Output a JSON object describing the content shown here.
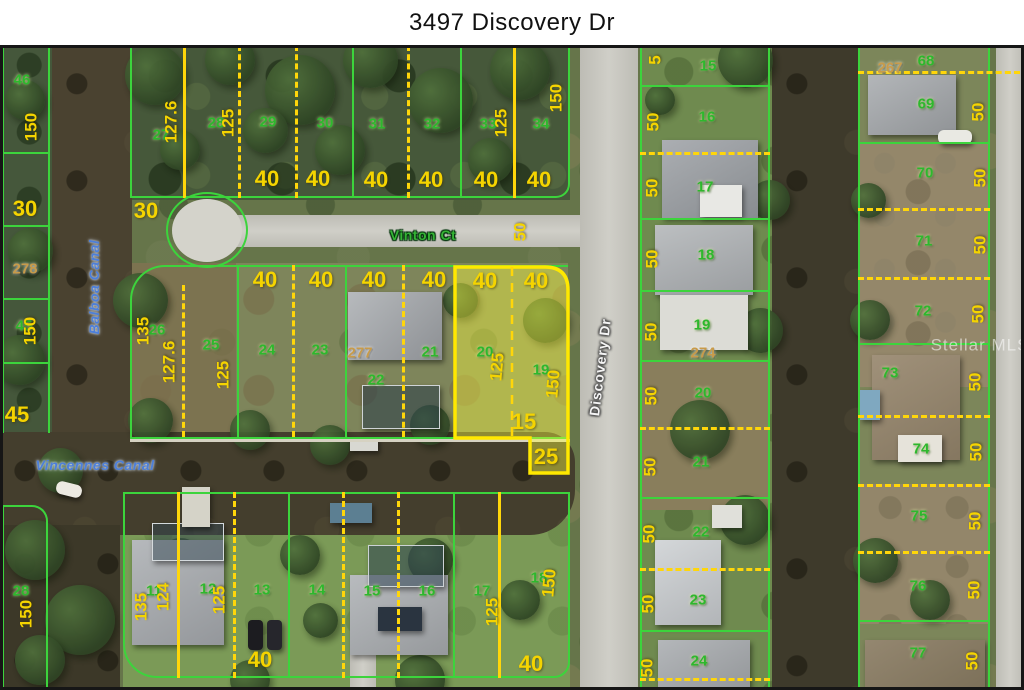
{
  "title": "3497 Discovery Dr",
  "watermark": "Stellar MLS",
  "streets": {
    "vinton": "Vinton Ct",
    "discovery": "Discovery Dr"
  },
  "canals": {
    "balboa": "Balboa Canal",
    "vincennes": "Vincennes Canal"
  },
  "highlighted_parcel": {
    "lot_numbers": [
      "20",
      "19"
    ],
    "dimensions": [
      "40",
      "40",
      "125",
      "150",
      "15",
      "25"
    ]
  },
  "colors": {
    "parcel_line_green": "#3cd43c",
    "dimension_yellow": "#ffd60a",
    "highlight_fill": "#ffff3c",
    "highlight_border": "#ffe800",
    "lot_number_green": "#2db82d",
    "parcel_id_tan": "#c89b4a",
    "canal_label_blue": "#4d7fd9",
    "road_label_white": "#f4f4f4"
  },
  "map_labels": [
    {
      "text": "46",
      "x": 22,
      "y": 80,
      "rot": 0,
      "type": "lot"
    },
    {
      "text": "150",
      "x": 31,
      "y": 127,
      "rot": -90,
      "type": "dim"
    },
    {
      "text": "30",
      "x": 25,
      "y": 209,
      "rot": 0,
      "type": "dimlg"
    },
    {
      "text": "278",
      "x": 25,
      "y": 269,
      "rot": 0,
      "type": "tan"
    },
    {
      "text": "45",
      "x": 24,
      "y": 326,
      "rot": 0,
      "type": "lot"
    },
    {
      "text": "150",
      "x": 30,
      "y": 331,
      "rot": -90,
      "type": "dim"
    },
    {
      "text": "45",
      "x": 17,
      "y": 415,
      "rot": 0,
      "type": "dimlg"
    },
    {
      "text": "28",
      "x": 21,
      "y": 591,
      "rot": 0,
      "type": "lot"
    },
    {
      "text": "150",
      "x": 26,
      "y": 614,
      "rot": -90,
      "type": "dim"
    },
    {
      "text": "Balboa Canal",
      "x": 94,
      "y": 287,
      "rot": -90,
      "type": "water-lbl"
    },
    {
      "text": "Vincennes Canal",
      "x": 95,
      "y": 465,
      "rot": 0,
      "type": "water-lbl"
    },
    {
      "text": "27",
      "x": 161,
      "y": 135,
      "rot": 0,
      "type": "lot"
    },
    {
      "text": "127.6",
      "x": 171,
      "y": 122,
      "rot": -90,
      "type": "dim"
    },
    {
      "text": "28",
      "x": 216,
      "y": 123,
      "rot": 0,
      "type": "lot"
    },
    {
      "text": "125",
      "x": 228,
      "y": 123,
      "rot": -90,
      "type": "dim"
    },
    {
      "text": "29",
      "x": 268,
      "y": 122,
      "rot": 0,
      "type": "lot"
    },
    {
      "text": "30",
      "x": 325,
      "y": 123,
      "rot": 0,
      "type": "lot"
    },
    {
      "text": "31",
      "x": 377,
      "y": 124,
      "rot": 0,
      "type": "lot"
    },
    {
      "text": "32",
      "x": 432,
      "y": 124,
      "rot": 0,
      "type": "lot"
    },
    {
      "text": "33",
      "x": 488,
      "y": 124,
      "rot": 0,
      "type": "lot"
    },
    {
      "text": "125",
      "x": 501,
      "y": 123,
      "rot": -90,
      "type": "dim"
    },
    {
      "text": "34",
      "x": 541,
      "y": 124,
      "rot": 0,
      "type": "lot"
    },
    {
      "text": "150",
      "x": 556,
      "y": 98,
      "rot": -90,
      "type": "dim"
    },
    {
      "text": "40",
      "x": 267,
      "y": 179,
      "rot": 0,
      "type": "dimlg"
    },
    {
      "text": "40",
      "x": 318,
      "y": 179,
      "rot": 0,
      "type": "dimlg"
    },
    {
      "text": "40",
      "x": 376,
      "y": 180,
      "rot": 0,
      "type": "dimlg"
    },
    {
      "text": "40",
      "x": 431,
      "y": 180,
      "rot": 0,
      "type": "dimlg"
    },
    {
      "text": "40",
      "x": 486,
      "y": 180,
      "rot": 0,
      "type": "dimlg"
    },
    {
      "text": "40",
      "x": 539,
      "y": 180,
      "rot": 0,
      "type": "dimlg"
    },
    {
      "text": "30",
      "x": 146,
      "y": 211,
      "rot": 0,
      "type": "dimlg"
    },
    {
      "text": "Vinton Ct",
      "x": 423,
      "y": 235,
      "rot": 0,
      "type": "street"
    },
    {
      "text": "50",
      "x": 520,
      "y": 232,
      "rot": -90,
      "type": "dim"
    },
    {
      "text": "26",
      "x": 157,
      "y": 330,
      "rot": 0,
      "type": "lot"
    },
    {
      "text": "135",
      "x": 143,
      "y": 331,
      "rot": -90,
      "type": "dim"
    },
    {
      "text": "127.6",
      "x": 169,
      "y": 362,
      "rot": -90,
      "type": "dim"
    },
    {
      "text": "25",
      "x": 211,
      "y": 345,
      "rot": 0,
      "type": "lot"
    },
    {
      "text": "125",
      "x": 223,
      "y": 375,
      "rot": -90,
      "type": "dim"
    },
    {
      "text": "24",
      "x": 267,
      "y": 350,
      "rot": 0,
      "type": "lot"
    },
    {
      "text": "23",
      "x": 320,
      "y": 350,
      "rot": 0,
      "type": "lot"
    },
    {
      "text": "277",
      "x": 360,
      "y": 353,
      "rot": 0,
      "type": "tan"
    },
    {
      "text": "22",
      "x": 376,
      "y": 380,
      "rot": 0,
      "type": "lot"
    },
    {
      "text": "21",
      "x": 430,
      "y": 352,
      "rot": 0,
      "type": "lot"
    },
    {
      "text": "40",
      "x": 265,
      "y": 280,
      "rot": 0,
      "type": "dimlg"
    },
    {
      "text": "40",
      "x": 321,
      "y": 280,
      "rot": 0,
      "type": "dimlg"
    },
    {
      "text": "40",
      "x": 374,
      "y": 280,
      "rot": 0,
      "type": "dimlg"
    },
    {
      "text": "40",
      "x": 434,
      "y": 280,
      "rot": 0,
      "type": "dimlg"
    },
    {
      "text": "40",
      "x": 485,
      "y": 281,
      "rot": 0,
      "type": "dimlg"
    },
    {
      "text": "40",
      "x": 536,
      "y": 281,
      "rot": 0,
      "type": "dimlg"
    },
    {
      "text": "20",
      "x": 485,
      "y": 352,
      "rot": 0,
      "type": "lot"
    },
    {
      "text": "125",
      "x": 497,
      "y": 367,
      "rot": -85,
      "type": "dim"
    },
    {
      "text": "19",
      "x": 541,
      "y": 370,
      "rot": 0,
      "type": "lot"
    },
    {
      "text": "150",
      "x": 553,
      "y": 384,
      "rot": -85,
      "type": "dim"
    },
    {
      "text": "15",
      "x": 524,
      "y": 422,
      "rot": 0,
      "type": "dimlg"
    },
    {
      "text": "25",
      "x": 546,
      "y": 457,
      "rot": 0,
      "type": "dimlg"
    },
    {
      "text": "Discovery Dr",
      "x": 600,
      "y": 367,
      "rot": -83,
      "type": "roadname"
    },
    {
      "text": "5",
      "x": 655,
      "y": 60,
      "rot": -90,
      "type": "dim"
    },
    {
      "text": "15",
      "x": 708,
      "y": 66,
      "rot": 0,
      "type": "lot"
    },
    {
      "text": "50",
      "x": 653,
      "y": 122,
      "rot": -90,
      "type": "dim"
    },
    {
      "text": "16",
      "x": 707,
      "y": 117,
      "rot": 0,
      "type": "lot"
    },
    {
      "text": "50",
      "x": 652,
      "y": 188,
      "rot": -90,
      "type": "dim"
    },
    {
      "text": "17",
      "x": 705,
      "y": 187,
      "rot": 0,
      "type": "lot"
    },
    {
      "text": "50",
      "x": 652,
      "y": 259,
      "rot": -90,
      "type": "dim"
    },
    {
      "text": "18",
      "x": 706,
      "y": 255,
      "rot": 0,
      "type": "lot"
    },
    {
      "text": "50",
      "x": 651,
      "y": 332,
      "rot": -90,
      "type": "dim"
    },
    {
      "text": "19",
      "x": 702,
      "y": 325,
      "rot": 0,
      "type": "lot"
    },
    {
      "text": "274",
      "x": 703,
      "y": 353,
      "rot": 0,
      "type": "tan"
    },
    {
      "text": "50",
      "x": 651,
      "y": 396,
      "rot": -90,
      "type": "dim"
    },
    {
      "text": "20",
      "x": 703,
      "y": 393,
      "rot": 0,
      "type": "lot"
    },
    {
      "text": "50",
      "x": 650,
      "y": 467,
      "rot": -90,
      "type": "dim"
    },
    {
      "text": "21",
      "x": 701,
      "y": 462,
      "rot": 0,
      "type": "lot"
    },
    {
      "text": "50",
      "x": 649,
      "y": 534,
      "rot": -90,
      "type": "dim"
    },
    {
      "text": "22",
      "x": 701,
      "y": 532,
      "rot": 0,
      "type": "lot"
    },
    {
      "text": "50",
      "x": 648,
      "y": 604,
      "rot": -90,
      "type": "dim"
    },
    {
      "text": "23",
      "x": 698,
      "y": 600,
      "rot": 0,
      "type": "lot"
    },
    {
      "text": "50",
      "x": 647,
      "y": 668,
      "rot": -90,
      "type": "dim"
    },
    {
      "text": "24",
      "x": 699,
      "y": 661,
      "rot": 0,
      "type": "lot"
    },
    {
      "text": "267",
      "x": 890,
      "y": 68,
      "rot": 0,
      "type": "tan"
    },
    {
      "text": "68",
      "x": 926,
      "y": 61,
      "rot": 0,
      "type": "lot"
    },
    {
      "text": "69",
      "x": 926,
      "y": 104,
      "rot": 0,
      "type": "lot"
    },
    {
      "text": "50",
      "x": 978,
      "y": 112,
      "rot": -90,
      "type": "dim"
    },
    {
      "text": "70",
      "x": 925,
      "y": 173,
      "rot": 0,
      "type": "lot"
    },
    {
      "text": "50",
      "x": 980,
      "y": 178,
      "rot": -90,
      "type": "dim"
    },
    {
      "text": "71",
      "x": 924,
      "y": 241,
      "rot": 0,
      "type": "lot"
    },
    {
      "text": "50",
      "x": 980,
      "y": 245,
      "rot": -90,
      "type": "dim"
    },
    {
      "text": "72",
      "x": 923,
      "y": 311,
      "rot": 0,
      "type": "lot"
    },
    {
      "text": "50",
      "x": 978,
      "y": 314,
      "rot": -90,
      "type": "dim"
    },
    {
      "text": "73",
      "x": 890,
      "y": 373,
      "rot": 0,
      "type": "lot"
    },
    {
      "text": "50",
      "x": 975,
      "y": 382,
      "rot": -90,
      "type": "dim"
    },
    {
      "text": "74",
      "x": 921,
      "y": 449,
      "rot": 0,
      "type": "lot"
    },
    {
      "text": "50",
      "x": 976,
      "y": 452,
      "rot": -90,
      "type": "dim"
    },
    {
      "text": "75",
      "x": 919,
      "y": 516,
      "rot": 0,
      "type": "lot"
    },
    {
      "text": "50",
      "x": 975,
      "y": 521,
      "rot": -90,
      "type": "dim"
    },
    {
      "text": "76",
      "x": 918,
      "y": 586,
      "rot": 0,
      "type": "lot"
    },
    {
      "text": "50",
      "x": 974,
      "y": 590,
      "rot": -90,
      "type": "dim"
    },
    {
      "text": "77",
      "x": 918,
      "y": 653,
      "rot": 0,
      "type": "lot"
    },
    {
      "text": "50",
      "x": 972,
      "y": 661,
      "rot": -90,
      "type": "dim"
    },
    {
      "text": "11",
      "x": 154,
      "y": 591,
      "rot": 0,
      "type": "lot"
    },
    {
      "text": "135",
      "x": 141,
      "y": 607,
      "rot": -90,
      "type": "dim"
    },
    {
      "text": "124",
      "x": 163,
      "y": 597,
      "rot": -90,
      "type": "dim"
    },
    {
      "text": "12",
      "x": 208,
      "y": 589,
      "rot": 0,
      "type": "lot"
    },
    {
      "text": "125",
      "x": 219,
      "y": 600,
      "rot": -90,
      "type": "dim"
    },
    {
      "text": "13",
      "x": 262,
      "y": 590,
      "rot": 0,
      "type": "lot"
    },
    {
      "text": "14",
      "x": 317,
      "y": 590,
      "rot": 0,
      "type": "lot"
    },
    {
      "text": "15",
      "x": 372,
      "y": 591,
      "rot": 0,
      "type": "lot"
    },
    {
      "text": "16",
      "x": 427,
      "y": 591,
      "rot": 0,
      "type": "lot"
    },
    {
      "text": "17",
      "x": 482,
      "y": 591,
      "rot": 0,
      "type": "lot"
    },
    {
      "text": "125",
      "x": 492,
      "y": 612,
      "rot": -90,
      "type": "dim"
    },
    {
      "text": "18",
      "x": 539,
      "y": 578,
      "rot": 0,
      "type": "lot"
    },
    {
      "text": "150",
      "x": 549,
      "y": 583,
      "rot": -85,
      "type": "dim"
    },
    {
      "text": "40",
      "x": 260,
      "y": 660,
      "rot": 0,
      "type": "dimlg"
    },
    {
      "text": "40",
      "x": 531,
      "y": 664,
      "rot": 0,
      "type": "dimlg"
    },
    {
      "text": "Stellar MLS",
      "x": 980,
      "y": 345,
      "rot": 0,
      "type": "wm"
    }
  ]
}
